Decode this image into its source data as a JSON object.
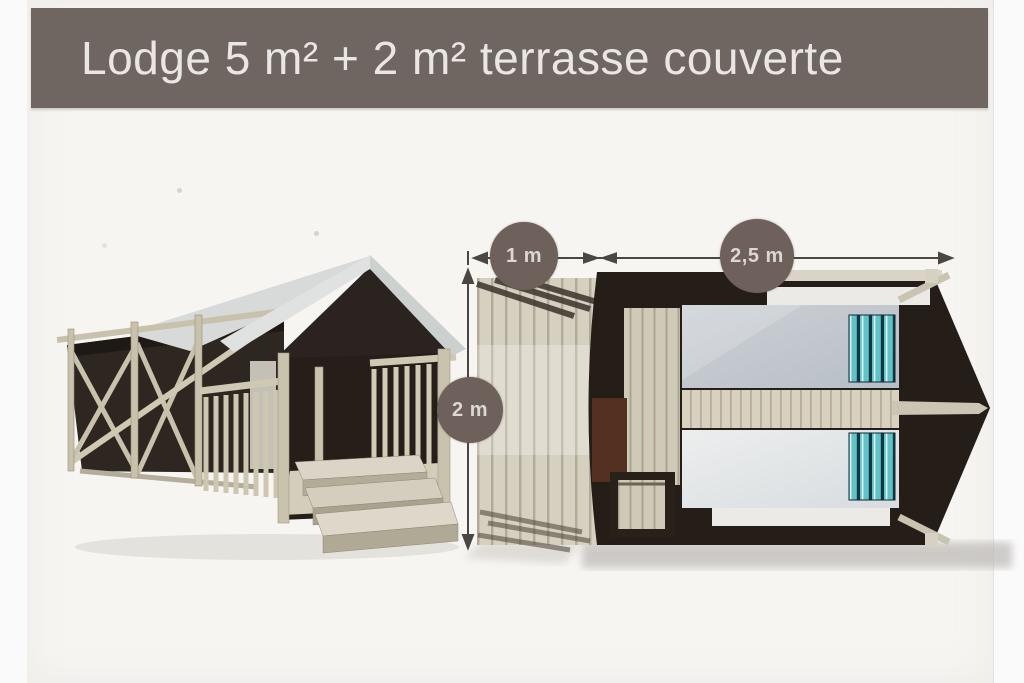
{
  "title": {
    "text": "Lodge 5 m² + 2 m² terrasse couverte"
  },
  "floorplan": {
    "dimensions": [
      {
        "name": "terrace-width",
        "label": "1 m"
      },
      {
        "name": "cabin-length",
        "label": "2,5 m"
      },
      {
        "name": "overall-depth",
        "label": "2 m"
      }
    ]
  },
  "colors": {
    "banner_background": "#6f6561",
    "banner_text": "#e9e6e3",
    "badge_background": "#6e615c",
    "badge_text": "#ddd7d2",
    "card_background": "#f7f5f2",
    "page_background": "#fbfafa",
    "canvas_dark": "#241d18",
    "wood_light": "#d6d0c1",
    "pillow_teal": "#5fc3c7",
    "mattress_gray": "#c2c8cd"
  }
}
